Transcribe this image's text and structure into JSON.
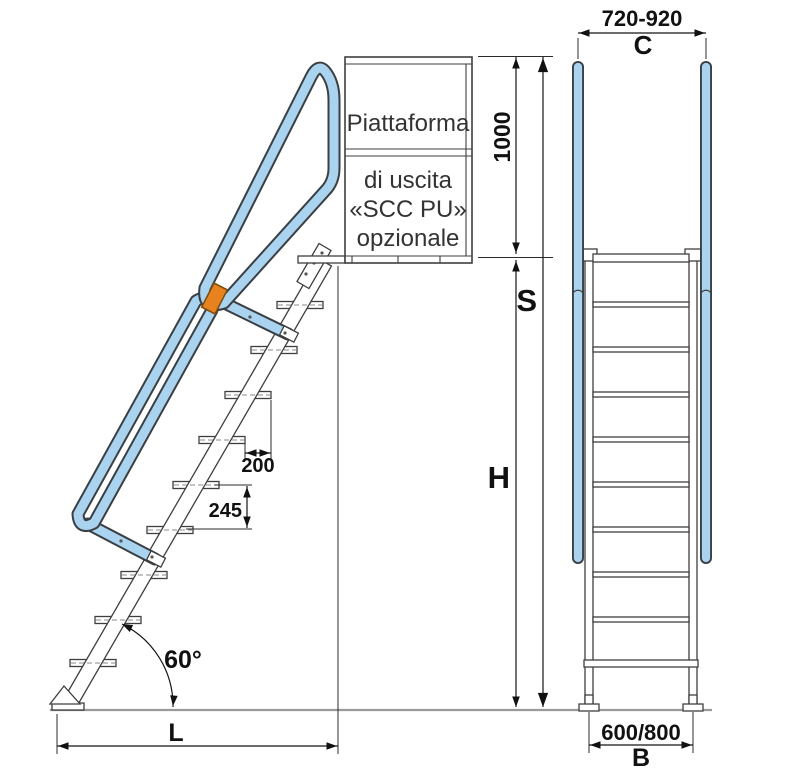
{
  "drawing": {
    "platform_label": {
      "line1": "Piattaforma",
      "line2": "di uscita",
      "line3": "«SCC PU»",
      "line4": "opzionale"
    },
    "side_view": {
      "angle": "60°",
      "step_depth": "200",
      "step_rise": "245",
      "guard_height": "1000",
      "total_height_letter": "S",
      "floor_height_letter": "H",
      "footprint_letter": "L"
    },
    "front_view": {
      "top_width": "720-920",
      "top_width_letter": "C",
      "base_width": "600/800",
      "base_width_letter": "B"
    },
    "colors": {
      "handrail_fill": "#a9d3ee",
      "handrail_outline": "#3a3f44",
      "clamp_orange": "#e8821e",
      "dimension_line": "#151515",
      "ground_gray": "#9a9a9a"
    }
  }
}
